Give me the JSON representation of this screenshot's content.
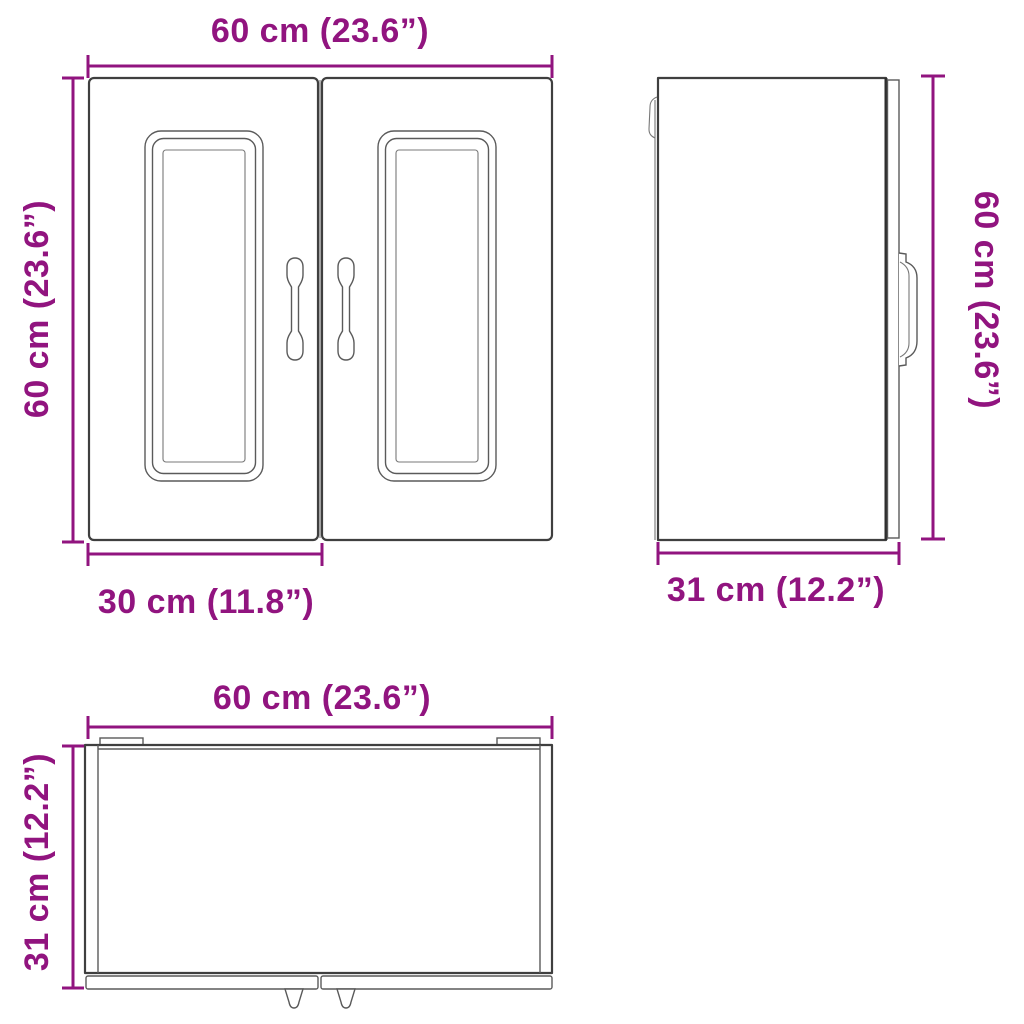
{
  "diagram": {
    "accent_color": "#91147F",
    "line_color": "#3f3f3f",
    "views": {
      "front": {
        "width_label": "60 cm (23.6”)",
        "height_label": "60 cm (23.6”)",
        "door_width_label": "30 cm (11.8”)"
      },
      "side": {
        "height_label": "60 cm (23.6”)",
        "depth_label": "31 cm (12.2”)"
      },
      "top": {
        "width_label": "60 cm (23.6”)",
        "depth_label": "31 cm (12.2”)"
      }
    }
  }
}
